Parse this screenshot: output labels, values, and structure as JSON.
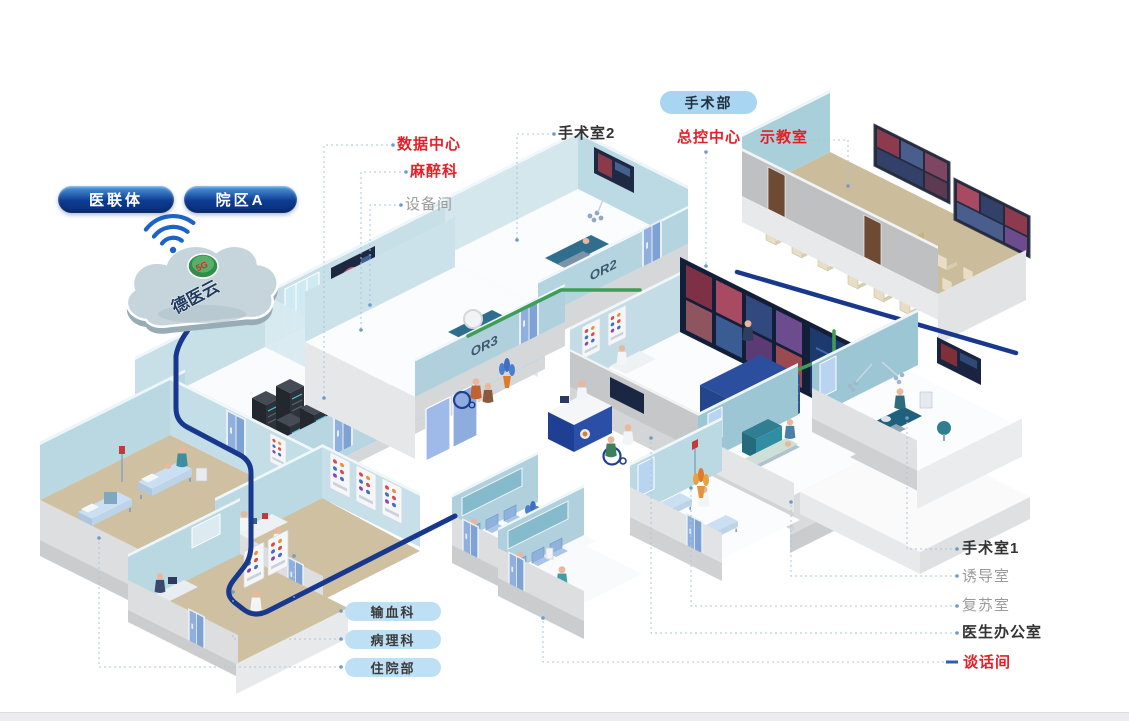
{
  "cloud": {
    "platform_name": "德医云",
    "badge": "5G"
  },
  "org_badges": {
    "alliance": "医联体",
    "campus": "院区A"
  },
  "department_badge": {
    "label": "手术部"
  },
  "callouts": {
    "data_center": "数据中心",
    "anesthesiology": "麻醉科",
    "equipment_room": "设备间",
    "operating_room_2": "手术室2",
    "master_control": "总控中心",
    "demo_classroom": "示教室",
    "operating_room_1": "手术室1",
    "induction_room": "诱导室",
    "recovery_room": "复苏室",
    "doctor_office": "医生办公室",
    "talk_room": "谈话间"
  },
  "department_pills": [
    {
      "label": "输血科"
    },
    {
      "label": "病理科"
    },
    {
      "label": "住院部"
    }
  ],
  "room_door_tags": {
    "or2": "OR2",
    "or3": "OR3"
  },
  "colors": {
    "highlight_red": "#E61E28",
    "muted_gray": "#9B9B9B",
    "dark_text": "#333333",
    "cable_navy": "#17388C",
    "cable_green": "#3E9E57",
    "pill_light_blue": "#BEE0F5",
    "dept_badge_blue": "#A7D5F2",
    "org_pill_blue": "#0D3C92",
    "wall_blue": "#B9D8E2",
    "floor_tan": "#CEC0A0"
  }
}
